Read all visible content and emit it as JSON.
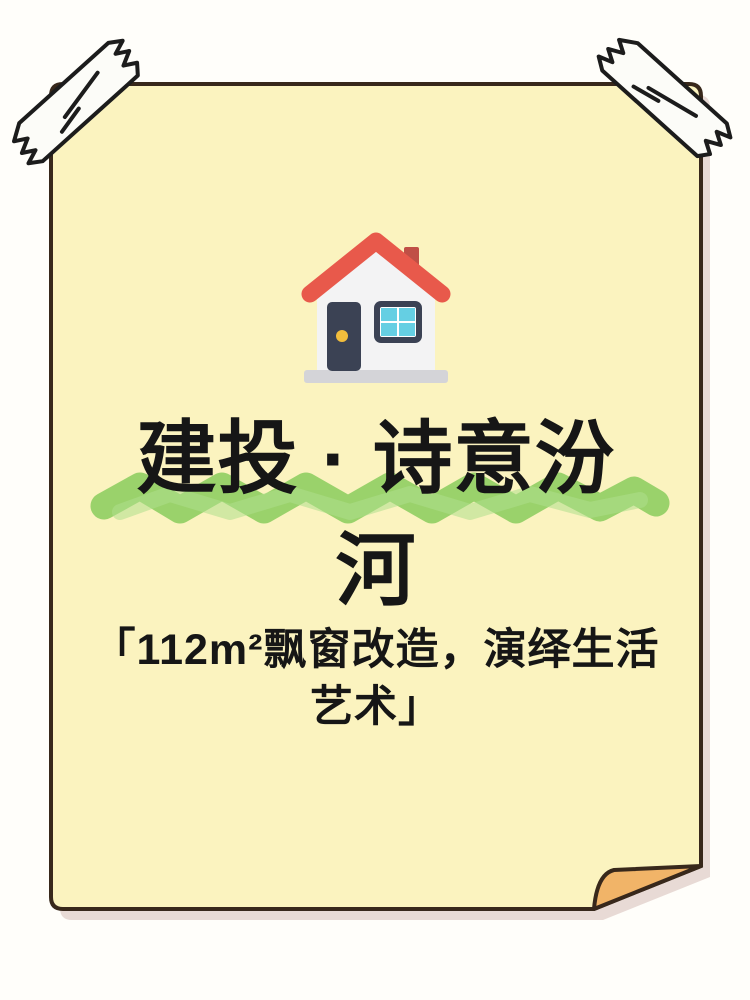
{
  "poster": {
    "title_line1": "建投 · 诗意汾",
    "title_line2": "河",
    "subtitle_line1": "「112m²飘窗改造，演绎生活",
    "subtitle_line2": "艺术」",
    "colors": {
      "background": "#FFFEFA",
      "paper": "#FBF3BF",
      "paper_border": "#38281B",
      "paper_shadow": "#E8DAD5",
      "fold": "#F1B468",
      "highlight_green": "#8CCD60",
      "highlight_green_light": "#AFDE8C",
      "tape_fill": "#FCFCF8",
      "tape_outline": "#1C1C1C",
      "title_text": "#161616",
      "house_roof": "#E8594B",
      "house_chimney": "#C04F46",
      "house_wall": "#F3F3F4",
      "house_door": "#3B4254",
      "house_knob": "#F2BD3C",
      "house_window_frame": "#3B4254",
      "house_window_pane": "#65CFE3",
      "house_base": "#D4D4D8"
    }
  }
}
